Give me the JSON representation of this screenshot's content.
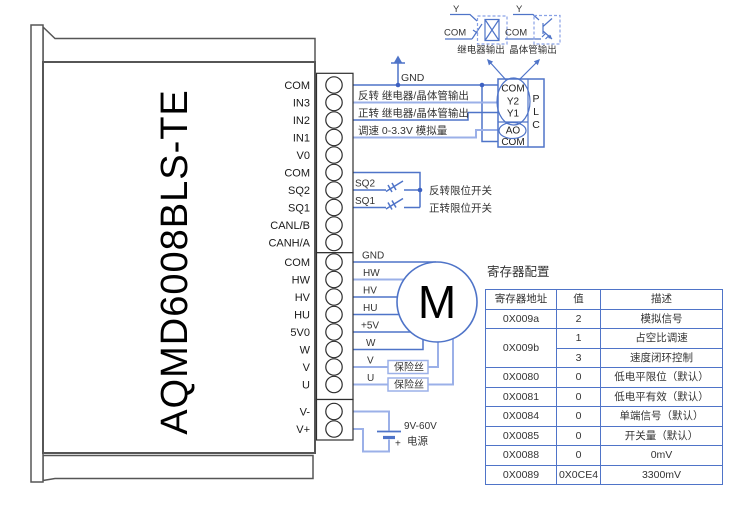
{
  "device": {
    "model": "AQMD6008BLS-TE"
  },
  "terminals": {
    "top": [
      "COM",
      "IN3",
      "IN2",
      "IN1",
      "V0",
      "COM",
      "SQ2",
      "SQ1",
      "CANL/B",
      "CANH/A"
    ],
    "middle": [
      "COM",
      "HW",
      "HV",
      "HU",
      "5V0",
      "W",
      "V",
      "U"
    ],
    "power": [
      "V-",
      "V+"
    ]
  },
  "signals": {
    "gnd": "GND",
    "in3_label": "反转 继电器/晶体管输出",
    "in2_label": "正转 继电器/晶体管输出",
    "in1_label": "调速  0-3.3V 模拟量",
    "sq2": "SQ2",
    "sq1": "SQ1",
    "sq2_desc": "反转限位开关",
    "sq1_desc": "正转限位开关"
  },
  "motor_wires": {
    "gnd": "GND",
    "hw": "HW",
    "hv": "HV",
    "hu": "HU",
    "v5": "+5V",
    "w": "W",
    "v": "V",
    "u": "U",
    "fuse": "保险丝"
  },
  "motor": {
    "label": "M"
  },
  "psu": {
    "range": "9V-60V",
    "label": "电源",
    "plus": "+"
  },
  "plc": {
    "t1": "COM",
    "t2": "Y2",
    "t3": "Y1",
    "t4": "AO",
    "t5": "COM",
    "p": "P",
    "l": "L",
    "c": "C"
  },
  "outputs": {
    "relay": {
      "y": "Y",
      "com": "COM",
      "label": "继电器输出"
    },
    "transistor": {
      "y": "Y",
      "com": "COM",
      "label": "晶体管输出"
    }
  },
  "register_table": {
    "title": "寄存器配置",
    "headers": [
      "寄存器地址",
      "值",
      "描述"
    ],
    "rows": [
      {
        "addr": "0X009a",
        "value": "2",
        "desc": "模拟信号"
      },
      {
        "addr": "0X009b",
        "value": "1",
        "desc": "占空比调速"
      },
      {
        "value": "3",
        "desc": "速度闭环控制"
      },
      {
        "addr": "0X0080",
        "value": "0",
        "desc": "低电平限位（默认）"
      },
      {
        "addr": "0X0081",
        "value": "0",
        "desc": "低电平有效（默认）"
      },
      {
        "addr": "0X0084",
        "value": "0",
        "desc": "单端信号（默认）"
      },
      {
        "addr": "0X0085",
        "value": "0",
        "desc": "开关量（默认）"
      },
      {
        "addr": "0X0088",
        "value": "0",
        "desc": "0mV"
      },
      {
        "addr": "0X0089",
        "value": "0X0CE4",
        "desc": "3300mV"
      }
    ]
  },
  "colors": {
    "wire_dark": "#4f74c8",
    "wire_light": "#9bb0e8",
    "outline": "#565656",
    "table_border": "#4f74c8",
    "text": "#333333"
  }
}
